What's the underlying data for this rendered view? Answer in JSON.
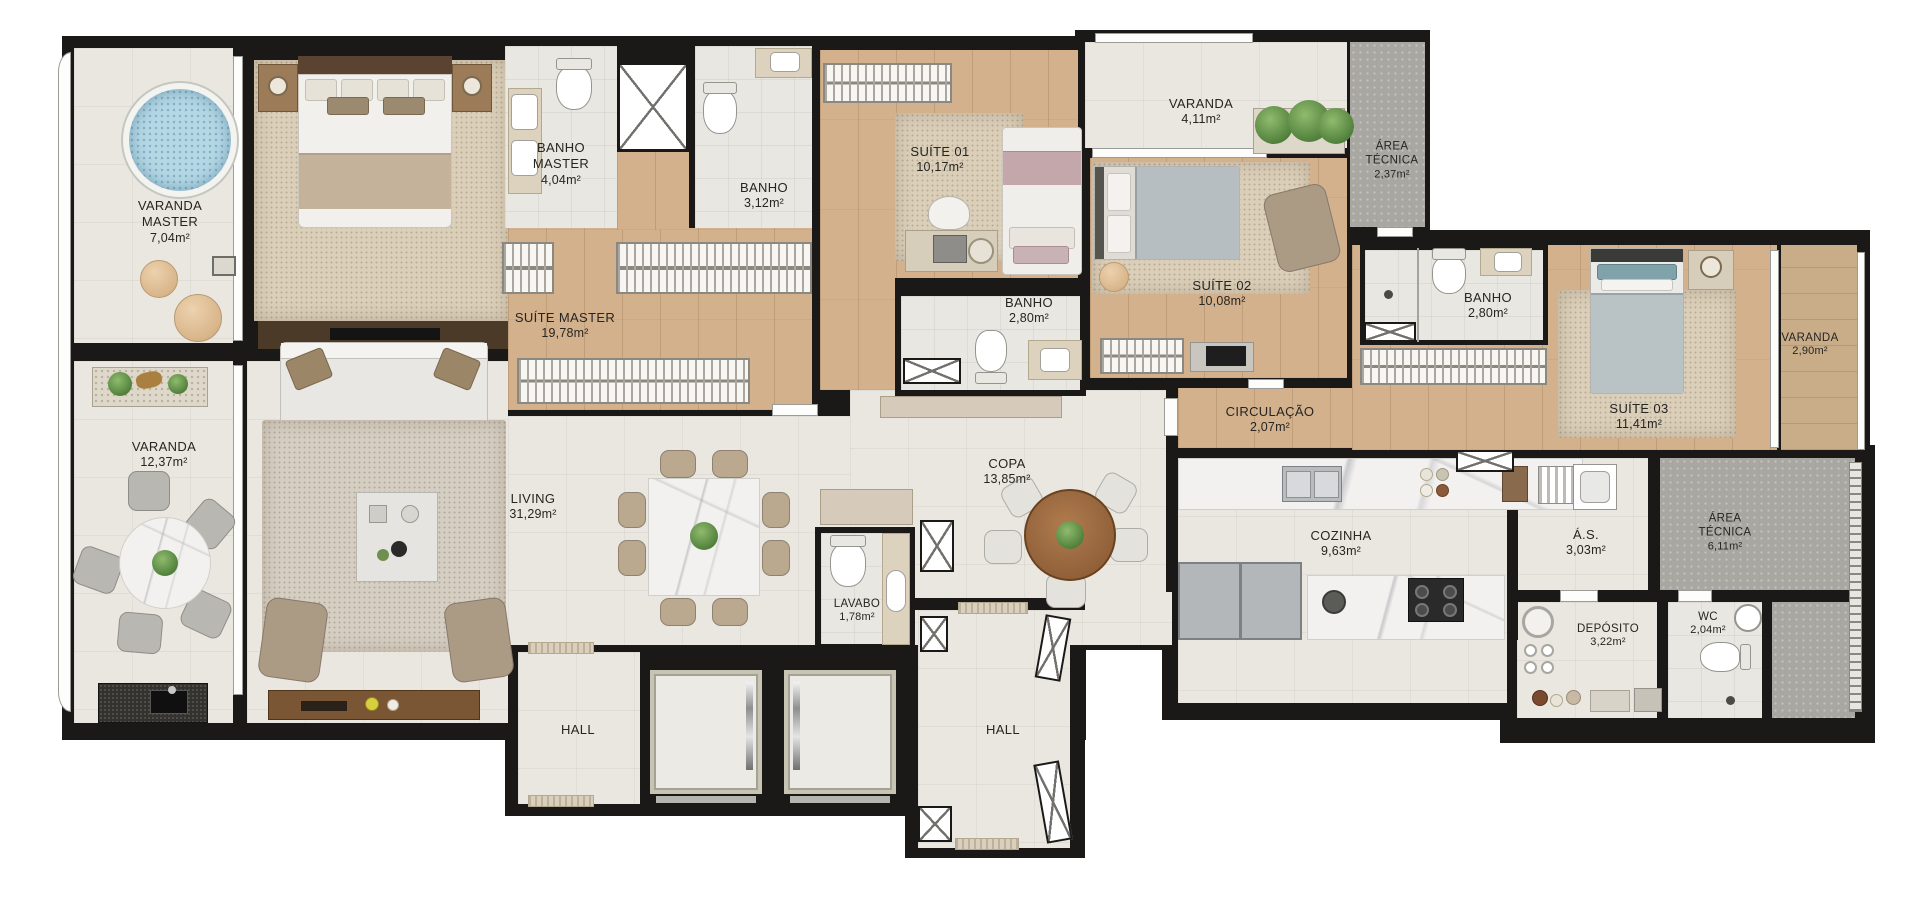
{
  "plan": {
    "type": "apartment-floor-plan",
    "rooms": [
      {
        "id": "varanda-master",
        "name": "VARANDA MASTER",
        "area": "7,04m²"
      },
      {
        "id": "suite-master",
        "name": "SUÍTE MASTER",
        "area": "19,78m²"
      },
      {
        "id": "banho-master",
        "name": "BANHO MASTER",
        "area": "4,04m²"
      },
      {
        "id": "banho-social",
        "name": "BANHO",
        "area": "3,12m²"
      },
      {
        "id": "suite-01",
        "name": "SUÍTE 01",
        "area": "10,17m²"
      },
      {
        "id": "banho-suite-01",
        "name": "BANHO",
        "area": "2,80m²"
      },
      {
        "id": "varanda-suites",
        "name": "VARANDA",
        "area": "4,11m²"
      },
      {
        "id": "area-tecnica-1",
        "name": "ÁREA TÉCNICA",
        "area": "2,37m²"
      },
      {
        "id": "suite-02",
        "name": "SUÍTE 02",
        "area": "10,08m²"
      },
      {
        "id": "circulacao",
        "name": "CIRCULAÇÃO",
        "area": "2,07m²"
      },
      {
        "id": "banho-suite-03",
        "name": "BANHO",
        "area": "2,80m²"
      },
      {
        "id": "suite-03",
        "name": "SUÍTE 03",
        "area": "11,41m²"
      },
      {
        "id": "varanda-suite-03",
        "name": "VARANDA",
        "area": "2,90m²"
      },
      {
        "id": "varanda-living",
        "name": "VARANDA",
        "area": "12,37m²"
      },
      {
        "id": "living",
        "name": "LIVING",
        "area": "31,29m²"
      },
      {
        "id": "copa",
        "name": "COPA",
        "area": "13,85m²"
      },
      {
        "id": "lavabo",
        "name": "LAVABO",
        "area": "1,78m²"
      },
      {
        "id": "cozinha",
        "name": "COZINHA",
        "area": "9,63m²"
      },
      {
        "id": "area-servico",
        "name": "Á.S.",
        "area": "3,03m²"
      },
      {
        "id": "area-tecnica-2",
        "name": "ÁREA TÉCNICA",
        "area": "6,11m²"
      },
      {
        "id": "deposito",
        "name": "DEPÓSITO",
        "area": "3,22m²"
      },
      {
        "id": "wc",
        "name": "WC",
        "area": "2,04m²"
      },
      {
        "id": "hall-social",
        "name": "HALL",
        "area": ""
      },
      {
        "id": "hall-servico",
        "name": "HALL",
        "area": ""
      }
    ],
    "colors": {
      "wall": "#1a1917",
      "tile": "#eae7e0",
      "wood": "#d2b18c",
      "deck": "#c9ad89",
      "carpet": "#dbcfba",
      "concrete": "#a9a7a2",
      "water": "#b5d8e5",
      "background": "#ffffff"
    }
  }
}
